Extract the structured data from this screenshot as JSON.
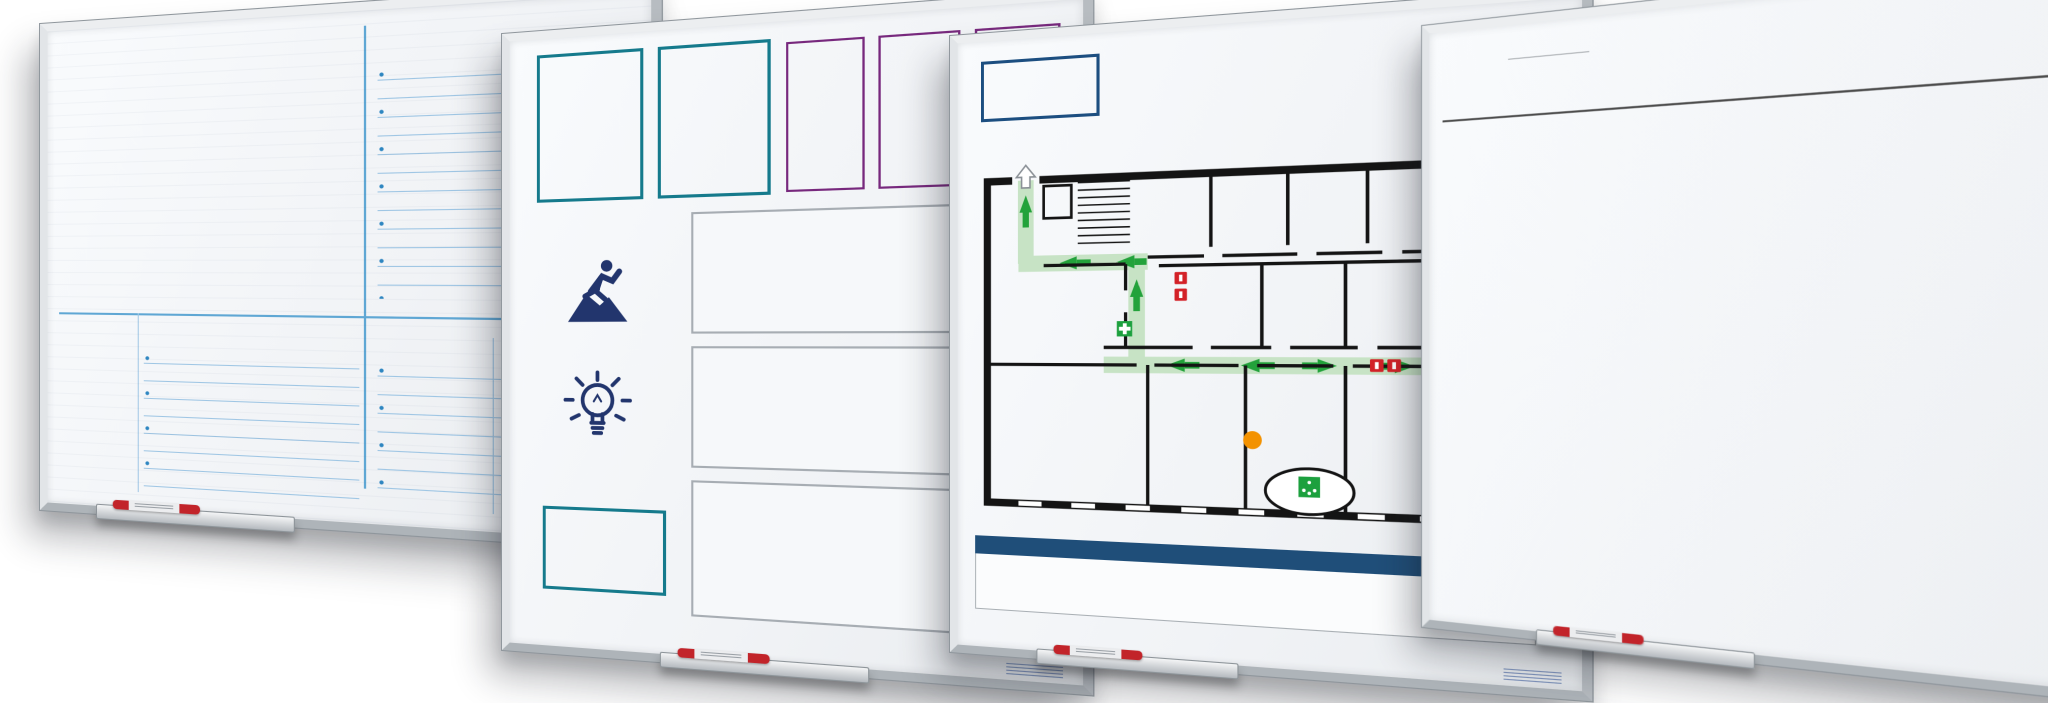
{
  "palette": {
    "navy": "#22356d",
    "blue": "#2e86c1",
    "teal": "#157a8c",
    "purple": "#77287d",
    "title_blue": "#1c4e80",
    "red": "#d32127",
    "green": "#1ca03e",
    "arrow_green": "#23a23b",
    "route_green": "#c7e3c5",
    "orange": "#f39200"
  },
  "boards": {
    "team_board": {
      "macon_label": "Macon",
      "team_label": "Team",
      "successen_label": "Successen",
      "werkacties_label": "Werkacties",
      "actie_label": "Actie",
      "wie_label": "Wie",
      "wanneer_label": "Wanneer",
      "smileys": [
        {
          "mood": "happy",
          "color": "#76b82a"
        },
        {
          "mood": "neutral",
          "color": "#f2dd1a"
        },
        {
          "mood": "sad",
          "color": "#db281e"
        }
      ],
      "tiles": [
        {
          "num": "1",
          "title": "Learning to use one's mind well",
          "subtext": "Leren en begrijpen is intellectueel uitdagend",
          "color": "#3a3a8c",
          "icon": "gears-person"
        },
        {
          "num": "2",
          "title": "Less is more, depth over coverage",
          "subtext": "Minder is meer, diepgang boven oppervlakkigheid",
          "color": "#f8e36a",
          "icon": "arrow-down"
        },
        {
          "num": "3",
          "title": "Goals apply to all students",
          "subtext": "De leerdoelen zijn voor alle leerlingen, de weg ernaar toe verschilt (zoals leerlingen verschillen)",
          "color": "#ec7f3e",
          "icon": "location-pin"
        },
        {
          "num": "4",
          "title": "Personalization",
          "subtext": "Leren en lesgeven is persoonlijk, leraren en leerlingen kennen elkaar",
          "color": "#2e9147",
          "icon": "puzzle"
        },
        {
          "num": "5",
          "title": "Student as worker, teacher as coach",
          "subtext": "De leerling leert, doet, denkt, maakt, en de leraar stimuleert en ondersteunt",
          "color": "#e2604c",
          "icon": "two-people"
        },
        {
          "num": "6",
          "title": "Resources dedicated to teaching and learning",
          "subtext": "Alles wordt ingezet voor leren en lesgeven, ook het beschikbare geld",
          "color": "#3fae92",
          "icon": "screen-euro"
        },
        {
          "num": "7",
          "title": "Demonstration of mastery",
          "subtext": "Laten zien wat je leert en kunt, en wie je bent",
          "color": "#145c40",
          "icon": "person-eye"
        },
        {
          "num": "8",
          "title": "Commitment to the entire school",
          "subtext": "Iedereen is verbonden met de hele school, en er verantwoordelijk voor",
          "color": "#6b92cc",
          "icon": "school-people"
        },
        {
          "num": "9",
          "title": "A tone of decency and trust",
          "subtext": "Leren en werken op basis van respect en vertrouwen, met hoge verwachtingen wederzijds",
          "color": "#176a68",
          "icon": "heart"
        },
        {
          "num": "10",
          "title": "Democracy and equity",
          "subtext": "Diversiteit wordt gewaardeerd, daarmee is een school een democratische gemeenschap en draagt er aan bij",
          "color": "#d65b80",
          "icon": "people-circle"
        }
      ]
    },
    "a3_board": {
      "team_label": "Team",
      "agenda_label": "Agenda",
      "tpi_labels": [
        "TPI",
        "TPI",
        "TPI"
      ],
      "question_label": "Waar loop je tegenaan?",
      "acties_label": "Acties",
      "a3_label": "A3 management",
      "sub_label": "Afdelingsoverstijgend",
      "logo_label": "Logo"
    },
    "evacuation_board": {
      "logo_label": "Logo",
      "title": "EMERGENCY EVACUATION PLAN BOARD GRO",
      "rooms": [
        "Room 3",
        "Room 4",
        "Office",
        "Office",
        "Storage",
        "Office",
        "Boardroom",
        "Room 2",
        "Room 1",
        "Office"
      ],
      "meeting_point_label": "Meeting point",
      "main_entrance_label": "Main entrance",
      "legend_header": "Explanation of symbols",
      "legend": [
        {
          "label": "You are here",
          "icon": "you-are-here"
        },
        {
          "label": "Meeting point",
          "icon": "meeting-point"
        },
        {
          "label": "First aid kit",
          "icon": "first-aid"
        },
        {
          "label": "Escape route",
          "icon": "escape-route"
        },
        {
          "label": "fire hose",
          "icon": "fire-hose"
        },
        {
          "label": "fire extinguisher",
          "icon": "fire-extinguisher"
        },
        {
          "label": "fire alarm station",
          "icon": "fire-alarm"
        }
      ]
    },
    "week_board": {
      "week_label": "Week:",
      "logo_label": "Logo",
      "rows": 5,
      "days": [
        {
          "label": "zondag",
          "color": "#8c5f9f"
        },
        {
          "label": "maandag",
          "color": "#e30613"
        },
        {
          "label": "dinsdag",
          "color": "#ef5b41"
        },
        {
          "label": "woensdag",
          "color": "#f6b912"
        },
        {
          "label": "donderdag",
          "color": "#2e9452"
        },
        {
          "label": "vrijdag",
          "color": "#0e72b8"
        },
        {
          "label": "zaterdag",
          "color": "#8d5fa0"
        }
      ]
    }
  }
}
